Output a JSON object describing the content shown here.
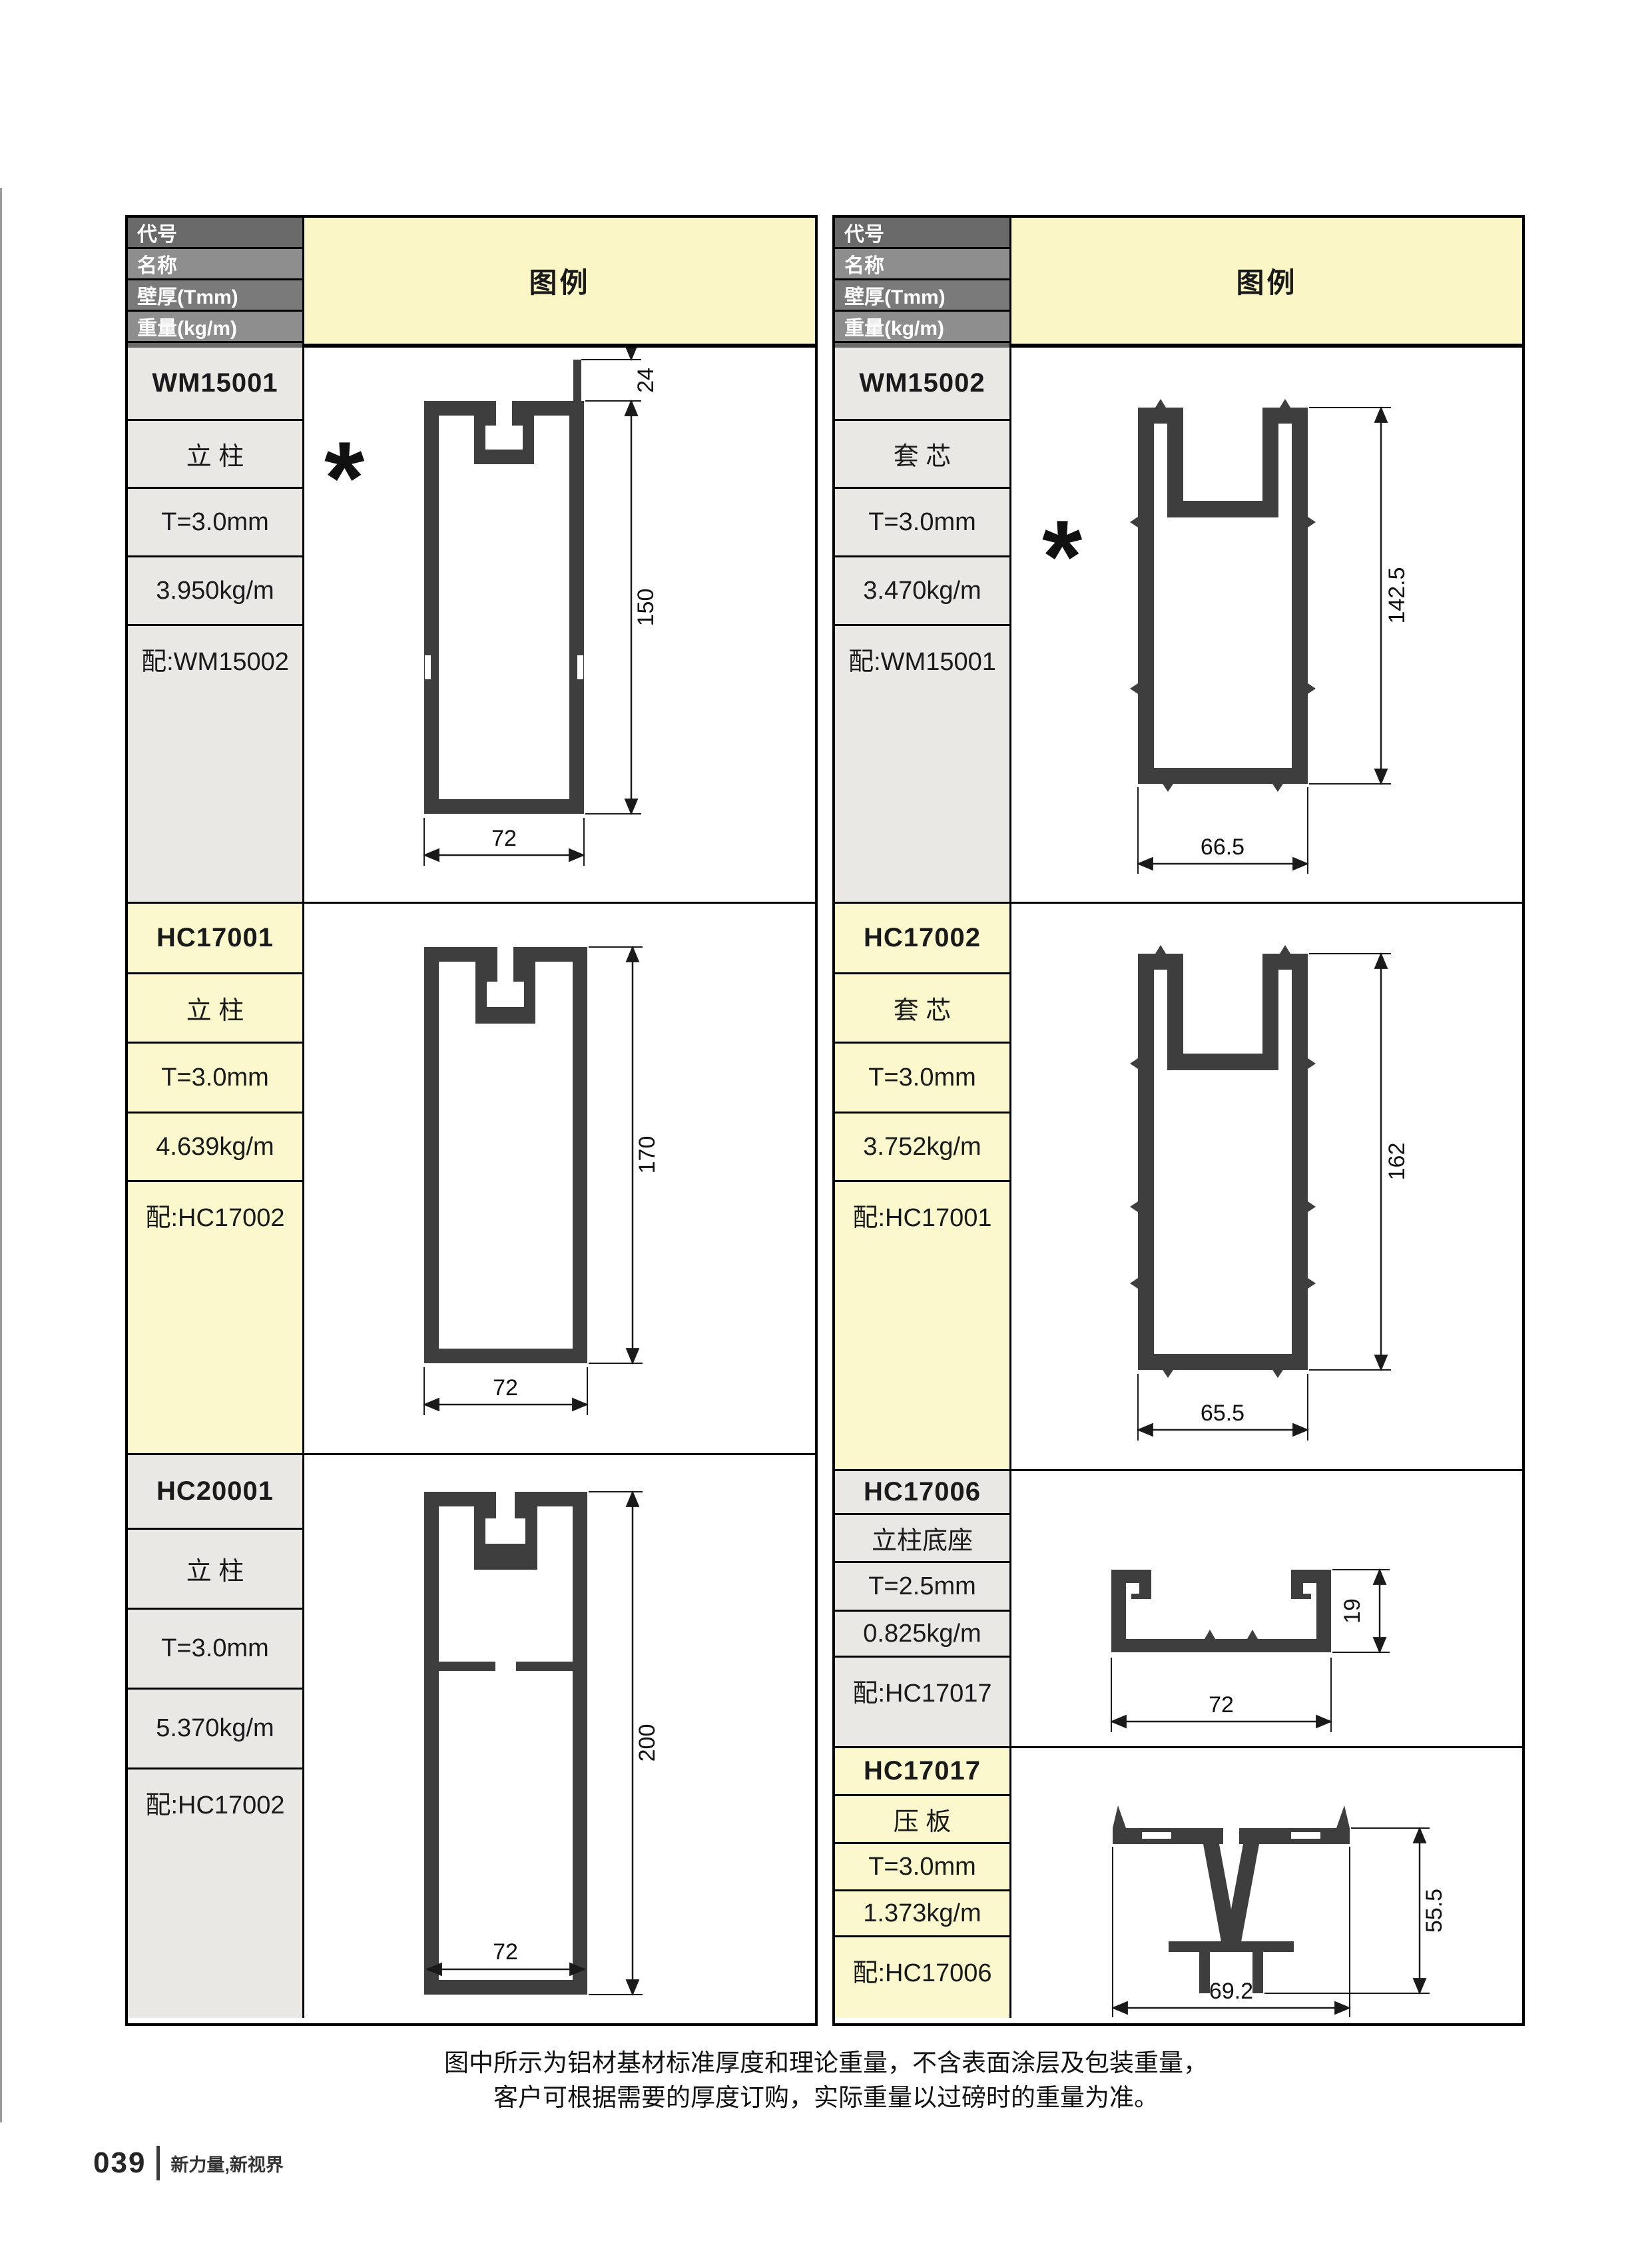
{
  "header": {
    "row_labels": [
      "代号",
      "名称",
      "壁厚(Tmm)",
      "重量(kg/m)",
      "配套"
    ],
    "legend_label": "图例"
  },
  "colors": {
    "legend_yellow": "#FAF6C6",
    "label_yellow": "#FBF8CE",
    "label_gray": "#E9E8E5",
    "header_gray_dark": "#696969",
    "header_gray_light": "#8E8E8E",
    "profile_fill": "#3E3E3E",
    "border_black": "#000000"
  },
  "profiles": {
    "wm15001": {
      "code": "WM15001",
      "name": "立 柱",
      "thickness": "T=3.0mm",
      "weight": "3.950kg/m",
      "match": "配:WM15002",
      "marker": "*",
      "dim_height": "150",
      "dim_width": "72",
      "dim_fin": "24"
    },
    "wm15002": {
      "code": "WM15002",
      "name": "套 芯",
      "thickness": "T=3.0mm",
      "weight": "3.470kg/m",
      "match": "配:WM15001",
      "marker": "*",
      "dim_height": "142.5",
      "dim_width": "66.5"
    },
    "hc17001": {
      "code": "HC17001",
      "name": "立 柱",
      "thickness": "T=3.0mm",
      "weight": "4.639kg/m",
      "match": "配:HC17002",
      "dim_height": "170",
      "dim_width": "72"
    },
    "hc17002": {
      "code": "HC17002",
      "name": "套 芯",
      "thickness": "T=3.0mm",
      "weight": "3.752kg/m",
      "match": "配:HC17001",
      "dim_height": "162",
      "dim_width": "65.5"
    },
    "hc20001": {
      "code": "HC20001",
      "name": "立 柱",
      "thickness": "T=3.0mm",
      "weight": "5.370kg/m",
      "match": "配:HC17002",
      "dim_height": "200",
      "dim_width": "72"
    },
    "hc17006": {
      "code": "HC17006",
      "name": "立柱底座",
      "thickness": "T=2.5mm",
      "weight": "0.825kg/m",
      "match": "配:HC17017",
      "dim_height": "19",
      "dim_width": "72"
    },
    "hc17017": {
      "code": "HC17017",
      "name": "压 板",
      "thickness": "T=3.0mm",
      "weight": "1.373kg/m",
      "match": "配:HC17006",
      "dim_height": "55.5",
      "dim_width": "69.2"
    }
  },
  "note": {
    "line1": "图中所示为铝材基材标准厚度和理论重量，不含表面涂层及包装重量，",
    "line2": "客户可根据需要的厚度订购，实际重量以过磅时的重量为准。"
  },
  "footer": {
    "page_number": "039",
    "tagline": "新力量,新视界"
  }
}
